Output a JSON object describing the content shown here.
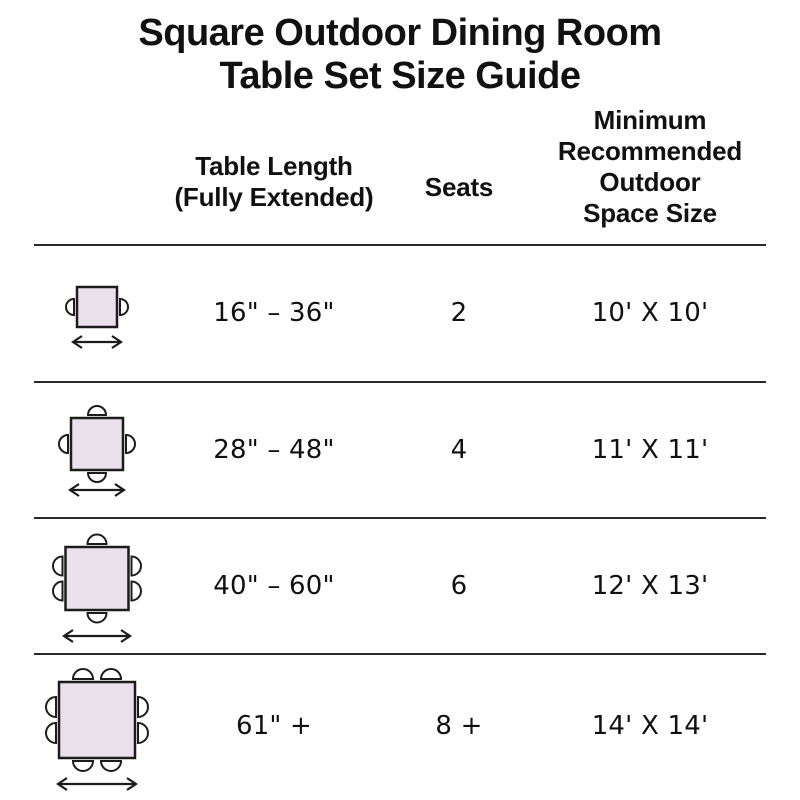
{
  "title": "Square Outdoor Dining Room\nTable Set Size Guide",
  "columns": {
    "length": "Table Length\n(Fully Extended)",
    "seats": "Seats",
    "space": "Minimum\nRecommended\nOutdoor\nSpace Size"
  },
  "rows": [
    {
      "length": "16\" – 36\"",
      "seats": "2",
      "space": "10' X 10'",
      "diagram": {
        "icon": "square-table-top-view",
        "chairs": {
          "top": 0,
          "right": 1,
          "bottom": 0,
          "left": 1
        },
        "extension_arrow": true
      }
    },
    {
      "length": "28\" – 48\"",
      "seats": "4",
      "space": "11' X 11'",
      "diagram": {
        "icon": "square-table-top-view",
        "chairs": {
          "top": 1,
          "right": 1,
          "bottom": 1,
          "left": 1
        },
        "extension_arrow": true
      }
    },
    {
      "length": "40\" – 60\"",
      "seats": "6",
      "space": "12' X 13'",
      "diagram": {
        "icon": "square-table-top-view",
        "chairs": {
          "top": 1,
          "right": 2,
          "bottom": 1,
          "left": 2
        },
        "extension_arrow": true
      }
    },
    {
      "length": "61\" +",
      "seats": "8 +",
      "space": "14' X 14'",
      "diagram": {
        "icon": "square-table-top-view",
        "chairs": {
          "top": 2,
          "right": 2,
          "bottom": 2,
          "left": 2
        },
        "extension_arrow": true
      }
    }
  ],
  "colors": {
    "background": "#ffffff",
    "text": "#111111",
    "divider": "#2a2a2a",
    "table_fill": "#e9e0ec",
    "outline": "#1c1c1c",
    "chair_fill": "#ffffff"
  }
}
